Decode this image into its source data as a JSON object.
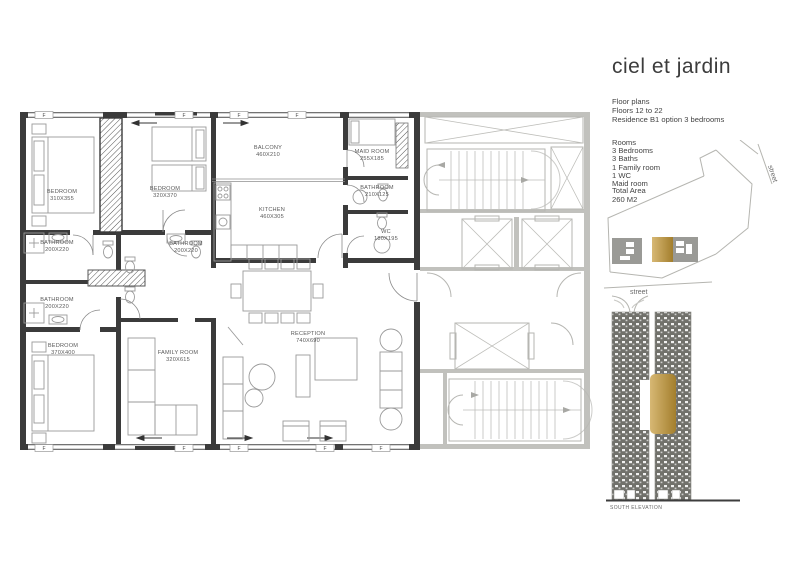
{
  "title": "ciel et jardin",
  "info": {
    "lines": [
      "Floor plans",
      "Floors  12 to 22",
      "Residence B1 option 3 bedrooms"
    ],
    "rooms_heading": "Rooms",
    "room_items": [
      "3 Bedrooms",
      "3 Baths",
      "1 Family room",
      "1 WC",
      "Maid room"
    ],
    "total_area_label": "Total Area",
    "total_area_value": "260 M2"
  },
  "site_plan": {
    "street_vertical": "street",
    "street_horizontal": "street"
  },
  "elevation": {
    "caption": "SOUTH ELEVATION"
  },
  "floor_plan": {
    "window_marker": "F",
    "rooms": [
      {
        "name": "BEDROOM",
        "dims": "310X355"
      },
      {
        "name": "BEDROOM",
        "dims": "320X370"
      },
      {
        "name": "BATHROOM",
        "dims": "200X220"
      },
      {
        "name": "BATHROOM",
        "dims": "200X220"
      },
      {
        "name": "BATHROOM",
        "dims": "200X220"
      },
      {
        "name": "BEDROOM",
        "dims": "370X400"
      },
      {
        "name": "BALCONY",
        "dims": "460X210"
      },
      {
        "name": "KITCHEN",
        "dims": "460X305"
      },
      {
        "name": "MAID ROOM",
        "dims": "255X185"
      },
      {
        "name": "BATHROOM",
        "dims": "210X125"
      },
      {
        "name": "WC",
        "dims": "180X195"
      },
      {
        "name": "FAMILY ROOM",
        "dims": "320X615"
      },
      {
        "name": "RECEPTION",
        "dims": "740X690"
      }
    ]
  },
  "colors": {
    "accent_gold": "#c8a254",
    "wall_dark": "#3b3b3b",
    "core_gray": "#b3b3ae"
  }
}
